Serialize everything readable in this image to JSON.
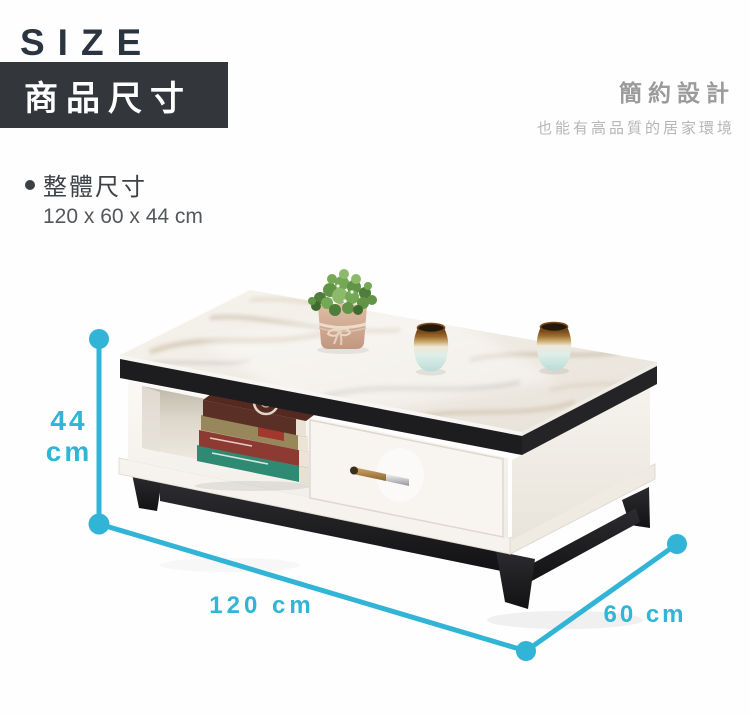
{
  "header": {
    "size_label": "SIZE",
    "product_dim_label": "商品尺寸"
  },
  "tagline": {
    "title": "簡約設計",
    "subtitle": "也能有高品質的居家環境"
  },
  "spec": {
    "overall_label": "整體尺寸",
    "overall_value": "120 x 60 x 44 cm"
  },
  "dimensions": {
    "height_value": "44",
    "height_unit": "cm",
    "length_label": "120 cm",
    "depth_label": "60 cm"
  },
  "colors": {
    "accent": "#31b4d6",
    "header_box_bg": "#33363b",
    "size_text": "#2b3540"
  }
}
